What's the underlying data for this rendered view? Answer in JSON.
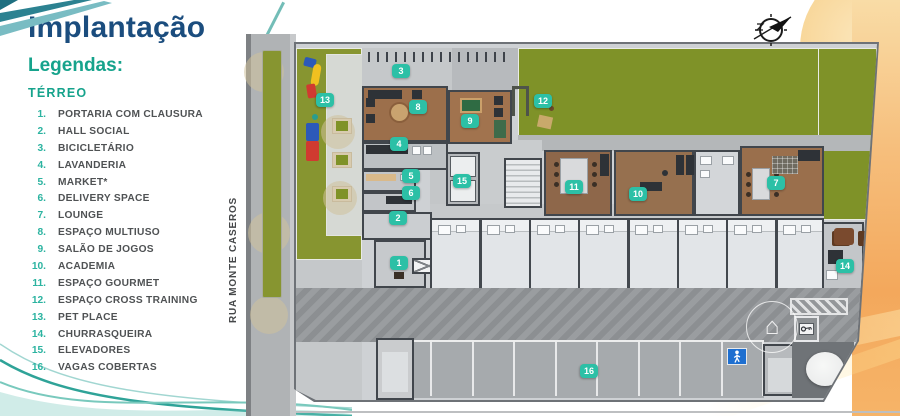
{
  "page": {
    "title": "Implantação",
    "legend_heading": "Legendas:",
    "floor_heading": "TÉRREO"
  },
  "legend_items": [
    {
      "num": "1.",
      "label": "PORTARIA COM CLAUSURA"
    },
    {
      "num": "2.",
      "label": "HALL SOCIAL"
    },
    {
      "num": "3.",
      "label": "BICICLETÁRIO"
    },
    {
      "num": "4.",
      "label": "LAVANDERIA"
    },
    {
      "num": "5.",
      "label": "MARKET*"
    },
    {
      "num": "6.",
      "label": "DELIVERY SPACE"
    },
    {
      "num": "7.",
      "label": "LOUNGE"
    },
    {
      "num": "8.",
      "label": "ESPAÇO MULTIUSO"
    },
    {
      "num": "9.",
      "label": "SALÃO DE JOGOS"
    },
    {
      "num": "10.",
      "label": "ACADEMIA"
    },
    {
      "num": "11.",
      "label": "ESPAÇO GOURMET"
    },
    {
      "num": "12.",
      "label": "ESPAÇO CROSS TRAINING"
    },
    {
      "num": "13.",
      "label": "PET PLACE"
    },
    {
      "num": "14.",
      "label": "CHURRASQUEIRA"
    },
    {
      "num": "15.",
      "label": "ELEVADORES"
    },
    {
      "num": "16.",
      "label": "VAGAS COBERTAS"
    }
  ],
  "street": {
    "name": "RUA MONTE CASEROS"
  },
  "watermark": {
    "glyph": "⌂",
    "arc_text": "IMAGEM"
  },
  "plan": {
    "markers": [
      {
        "n": "1",
        "x": 399,
        "y": 263
      },
      {
        "n": "2",
        "x": 398,
        "y": 218
      },
      {
        "n": "3",
        "x": 401,
        "y": 71
      },
      {
        "n": "4",
        "x": 399,
        "y": 144
      },
      {
        "n": "5",
        "x": 411,
        "y": 176
      },
      {
        "n": "6",
        "x": 411,
        "y": 193
      },
      {
        "n": "7",
        "x": 776,
        "y": 183
      },
      {
        "n": "8",
        "x": 418,
        "y": 107
      },
      {
        "n": "9",
        "x": 470,
        "y": 121
      },
      {
        "n": "10",
        "x": 638,
        "y": 194
      },
      {
        "n": "11",
        "x": 574,
        "y": 187
      },
      {
        "n": "12",
        "x": 543,
        "y": 101
      },
      {
        "n": "13",
        "x": 325,
        "y": 100
      },
      {
        "n": "14",
        "x": 845,
        "y": 266
      },
      {
        "n": "15",
        "x": 462,
        "y": 181
      },
      {
        "n": "16",
        "x": 589,
        "y": 371
      }
    ]
  },
  "icons": {
    "compass": "north-arrow",
    "pedestrian": "walking-person",
    "key": "key"
  },
  "colors": {
    "title-blue": "#1b4d7e",
    "accent-teal": "#16a38c",
    "legend-num-teal": "#2bb3a0",
    "legend-text": "#4f5254",
    "marker-teal": "#2cc0a6",
    "grass": "#879530",
    "lawn": "#7f9228",
    "wood": "#9c6f4b",
    "road": "#b0b3b5",
    "plot": "#ced1d4",
    "driveway": "#95989b",
    "orange-band": "#f3a85c",
    "orange-light": "#f9dca6",
    "sign-blue": "#1e6fd0",
    "wall": "#41464c"
  }
}
